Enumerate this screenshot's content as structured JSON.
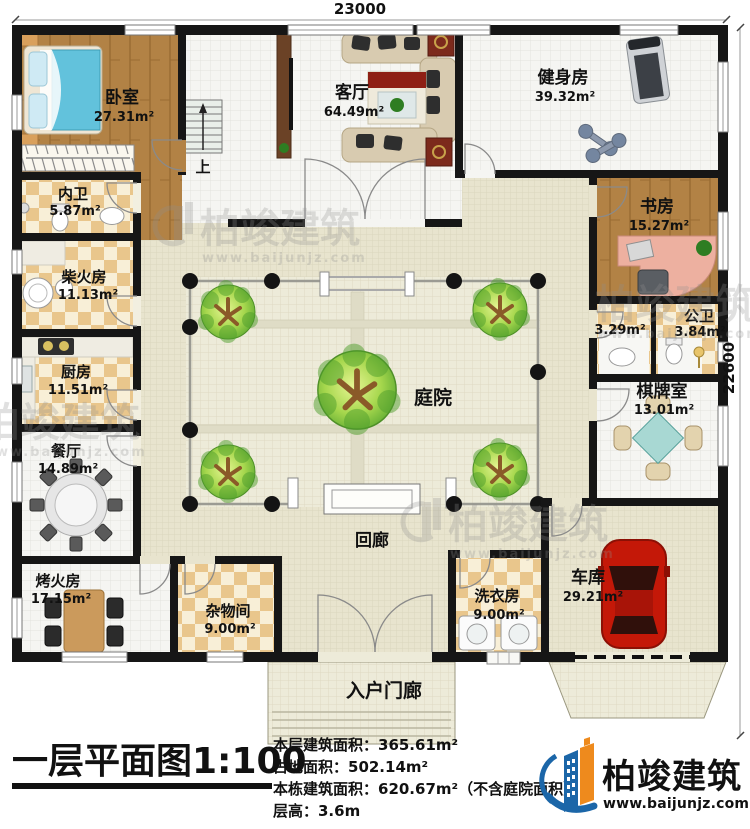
{
  "dimensions": {
    "top": "23000",
    "right": "22600"
  },
  "rooms": {
    "bedroom": {
      "label": "卧室",
      "area": "27.31m²"
    },
    "living": {
      "label": "客厅",
      "area": "64.49m²"
    },
    "gym": {
      "label": "健身房",
      "area": "39.32m²"
    },
    "study": {
      "label": "书房",
      "area": "15.27m²"
    },
    "ensuite": {
      "label": "内卫",
      "area": "5.87m²"
    },
    "firewood": {
      "label": "柴火房",
      "area": "11.13m²"
    },
    "kitchen": {
      "label": "厨房",
      "area": "11.51m²"
    },
    "dining": {
      "label": "餐厅",
      "area": "14.89m²"
    },
    "washarea": {
      "area": "3.29m²"
    },
    "publicbath": {
      "label": "公卫",
      "area": "3.84m²"
    },
    "chess": {
      "label": "棋牌室",
      "area": "13.01m²"
    },
    "heating": {
      "label": "烤火房",
      "area": "17.15m²"
    },
    "storage": {
      "label": "杂物间",
      "area": "9.00m²"
    },
    "laundry": {
      "label": "洗衣房",
      "area": "9.00m²"
    },
    "garage": {
      "label": "车库",
      "area": "29.21m²"
    },
    "courtyard": {
      "label": "庭院"
    },
    "corridor": {
      "label": "回廊"
    },
    "porch": {
      "label": "入户门廊"
    },
    "stairs": {
      "label": "上"
    }
  },
  "titleblock": {
    "title": "一层平面图1:100",
    "stats": [
      "本层建筑面积：365.61m²",
      "占地面积：502.14m²",
      "本栋建筑面积：620.67m²（不含庭院面积）",
      "层高：3.6m"
    ]
  },
  "branding": {
    "name": "柏竣建筑",
    "site": "www.baijunjz.com"
  },
  "watermark": {
    "name": "柏竣建筑",
    "site": "www.baijunjz.com"
  }
}
